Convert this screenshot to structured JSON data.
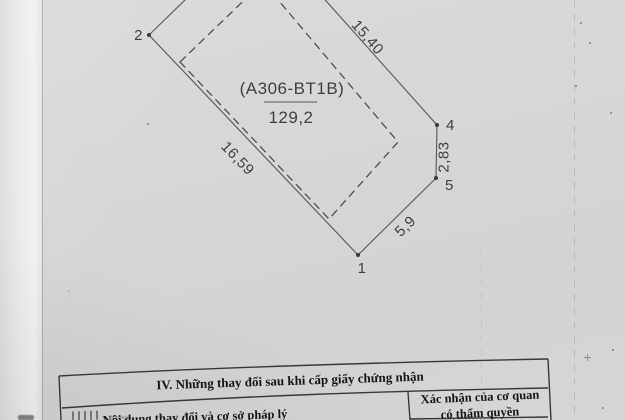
{
  "colors": {
    "paper": "#d6d8d7",
    "paper_fold": "#f0f2f1",
    "diagram_line": "#5e5e5e",
    "diagram_text": "#3f3f3f",
    "table_border": "#383838",
    "table_text": "#151515"
  },
  "diagram": {
    "parcel_label": "(A306-BT1B)",
    "area_value": "129,2",
    "vertex_labels": {
      "v1": "1",
      "v2": "2",
      "v4": "4",
      "v5": "5"
    },
    "edge_lengths": {
      "north_east": "15,40",
      "south_west": "16,59",
      "east": "2,83",
      "south_east": "5,9"
    }
  },
  "table": {
    "section_title": "IV. Những thay đổi sau khi cấp giấy chứng nhận",
    "columns": {
      "content": "Nội dung thay đổi và cơ sở pháp lý",
      "confirm_line1": "Xác nhận của cơ quan",
      "confirm_line2": "có thẩm quyền"
    }
  }
}
